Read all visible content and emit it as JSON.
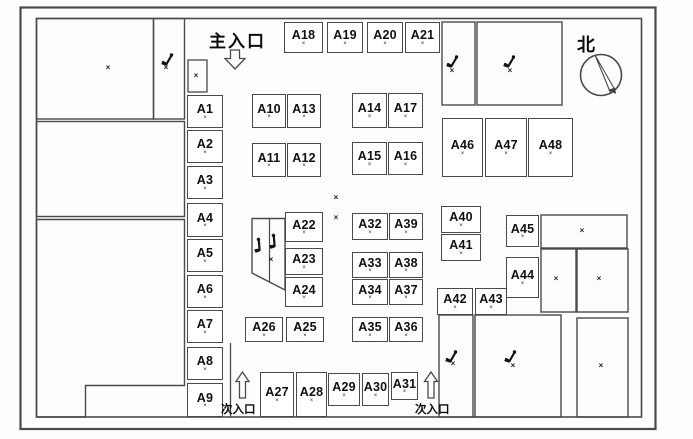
{
  "labels": {
    "main_entrance": "主入口",
    "secondary_entrance_left": "次入口",
    "secondary_entrance_right": "次入口",
    "north": "北"
  },
  "decorations": {
    "booth_marker": "×",
    "room_marker": "×"
  },
  "colors": {
    "line": "#4a4a4a",
    "text": "#101010",
    "background": "#fdfdfd"
  },
  "booths": [
    {
      "label": "A1",
      "x": 187,
      "y": 95,
      "w": 36,
      "h": 33
    },
    {
      "label": "A2",
      "x": 187,
      "y": 130,
      "w": 36,
      "h": 33
    },
    {
      "label": "A3",
      "x": 187,
      "y": 166,
      "w": 36,
      "h": 33
    },
    {
      "label": "A4",
      "x": 187,
      "y": 203,
      "w": 36,
      "h": 34
    },
    {
      "label": "A5",
      "x": 187,
      "y": 239,
      "w": 36,
      "h": 33
    },
    {
      "label": "A6",
      "x": 187,
      "y": 275,
      "w": 36,
      "h": 33
    },
    {
      "label": "A7",
      "x": 187,
      "y": 310,
      "w": 36,
      "h": 33
    },
    {
      "label": "A8",
      "x": 187,
      "y": 347,
      "w": 36,
      "h": 33
    },
    {
      "label": "A9",
      "x": 187,
      "y": 383,
      "w": 36,
      "h": 34
    },
    {
      "label": "A10",
      "x": 252,
      "y": 94,
      "w": 34,
      "h": 34
    },
    {
      "label": "A13",
      "x": 287,
      "y": 94,
      "w": 34,
      "h": 34
    },
    {
      "label": "A11",
      "x": 252,
      "y": 143,
      "w": 34,
      "h": 34
    },
    {
      "label": "A12",
      "x": 287,
      "y": 143,
      "w": 34,
      "h": 34
    },
    {
      "label": "A14",
      "x": 352,
      "y": 93,
      "w": 35,
      "h": 35
    },
    {
      "label": "A17",
      "x": 388,
      "y": 93,
      "w": 35,
      "h": 35
    },
    {
      "label": "A15",
      "x": 352,
      "y": 142,
      "w": 35,
      "h": 33
    },
    {
      "label": "A16",
      "x": 388,
      "y": 142,
      "w": 35,
      "h": 33
    },
    {
      "label": "A18",
      "x": 284,
      "y": 22,
      "w": 39,
      "h": 31
    },
    {
      "label": "A19",
      "x": 327,
      "y": 22,
      "w": 36,
      "h": 31
    },
    {
      "label": "A20",
      "x": 367,
      "y": 22,
      "w": 36,
      "h": 31
    },
    {
      "label": "A21",
      "x": 405,
      "y": 22,
      "w": 35,
      "h": 31
    },
    {
      "label": "A46",
      "x": 442,
      "y": 118,
      "w": 41,
      "h": 59
    },
    {
      "label": "A47",
      "x": 485,
      "y": 118,
      "w": 42,
      "h": 59
    },
    {
      "label": "A48",
      "x": 528,
      "y": 118,
      "w": 45,
      "h": 59
    },
    {
      "label": "A22",
      "x": 285,
      "y": 212,
      "w": 38,
      "h": 30
    },
    {
      "label": "A23",
      "x": 285,
      "y": 248,
      "w": 38,
      "h": 27
    },
    {
      "label": "A24",
      "x": 285,
      "y": 277,
      "w": 38,
      "h": 30
    },
    {
      "label": "A26",
      "x": 245,
      "y": 317,
      "w": 38,
      "h": 25
    },
    {
      "label": "A25",
      "x": 286,
      "y": 317,
      "w": 38,
      "h": 25
    },
    {
      "label": "A32",
      "x": 352,
      "y": 213,
      "w": 36,
      "h": 27
    },
    {
      "label": "A39",
      "x": 389,
      "y": 213,
      "w": 34,
      "h": 27
    },
    {
      "label": "A33",
      "x": 352,
      "y": 252,
      "w": 36,
      "h": 26
    },
    {
      "label": "A38",
      "x": 389,
      "y": 252,
      "w": 34,
      "h": 26
    },
    {
      "label": "A34",
      "x": 352,
      "y": 279,
      "w": 36,
      "h": 26
    },
    {
      "label": "A37",
      "x": 389,
      "y": 279,
      "w": 34,
      "h": 26
    },
    {
      "label": "A35",
      "x": 352,
      "y": 317,
      "w": 36,
      "h": 25
    },
    {
      "label": "A36",
      "x": 389,
      "y": 317,
      "w": 34,
      "h": 25
    },
    {
      "label": "A40",
      "x": 441,
      "y": 206,
      "w": 40,
      "h": 27
    },
    {
      "label": "A41",
      "x": 441,
      "y": 234,
      "w": 40,
      "h": 27
    },
    {
      "label": "A45",
      "x": 506,
      "y": 215,
      "w": 33,
      "h": 32
    },
    {
      "label": "A44",
      "x": 506,
      "y": 257,
      "w": 33,
      "h": 41
    },
    {
      "label": "A42",
      "x": 437,
      "y": 288,
      "w": 36,
      "h": 27
    },
    {
      "label": "A43",
      "x": 475,
      "y": 288,
      "w": 32,
      "h": 27
    },
    {
      "label": "A27",
      "x": 260,
      "y": 372,
      "w": 34,
      "h": 45
    },
    {
      "label": "A28",
      "x": 296,
      "y": 372,
      "w": 31,
      "h": 45
    },
    {
      "label": "A29",
      "x": 328,
      "y": 373,
      "w": 32,
      "h": 33
    },
    {
      "label": "A30",
      "x": 362,
      "y": 373,
      "w": 27,
      "h": 33
    },
    {
      "label": "A31",
      "x": 391,
      "y": 372,
      "w": 27,
      "h": 28
    }
  ],
  "cross_marks": [
    [
      108,
      68
    ],
    [
      166,
      68
    ],
    [
      196,
      76
    ],
    [
      452,
      71
    ],
    [
      510,
      71
    ],
    [
      336,
      198
    ],
    [
      336,
      218
    ],
    [
      271,
      260
    ],
    [
      582,
      231
    ],
    [
      556,
      279
    ],
    [
      599,
      279
    ],
    [
      601,
      366
    ],
    [
      453,
      364
    ],
    [
      513,
      366
    ]
  ],
  "stair_icons": [
    {
      "x": 161,
      "y": 52,
      "r": 0
    },
    {
      "x": 446,
      "y": 54,
      "r": 0
    },
    {
      "x": 503,
      "y": 54,
      "r": 0
    },
    {
      "x": 251,
      "y": 238,
      "r": -35
    },
    {
      "x": 266,
      "y": 234,
      "r": -35
    },
    {
      "x": 445,
      "y": 349,
      "r": 0
    },
    {
      "x": 504,
      "y": 349,
      "r": 0
    }
  ]
}
